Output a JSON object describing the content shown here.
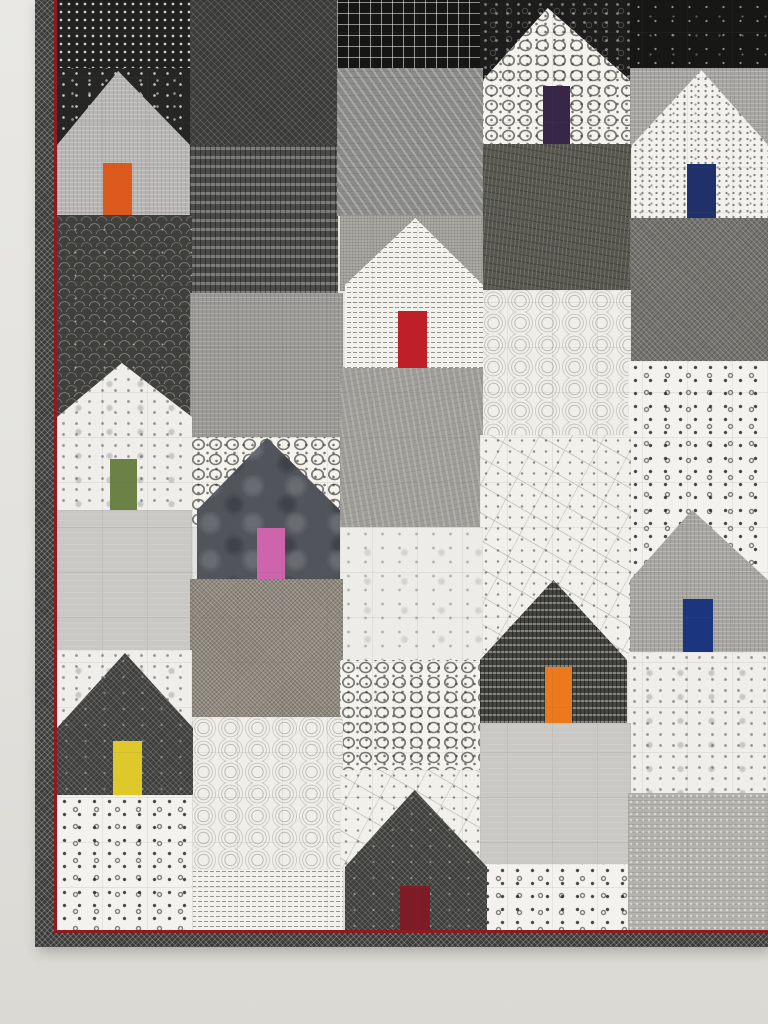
{
  "scene": {
    "alt_text": "Modern patchwork wall quilt of pieced house blocks in black, white and gray printed fabrics, each house with a single bright colored door, bound in dark fabric with a thin red flange, hanging on a pale gray wall"
  },
  "wall": {
    "color_top": "#e9e8e4",
    "color_bottom": "#dbd9d4"
  },
  "quilt": {
    "x": 35,
    "y": 0,
    "width": 733,
    "height": 947,
    "binding_color": "#3a3a38",
    "flange_color": "#8e1b22",
    "quilting_grid_spacing_px": 45,
    "binding": [
      {
        "name": "binding-left",
        "kind": "binding",
        "x": 35,
        "y": 0,
        "w": 19,
        "h": 947
      },
      {
        "name": "binding-bottom",
        "kind": "binding",
        "x": 35,
        "y": 933,
        "w": 733,
        "h": 14
      },
      {
        "name": "flange-left",
        "kind": "flange",
        "x": 54,
        "y": 0,
        "w": 3,
        "h": 933
      },
      {
        "name": "flange-bottom",
        "kind": "flange",
        "x": 54,
        "y": 930,
        "w": 714,
        "h": 3
      }
    ],
    "patches": [
      {
        "name": "black-dot-rows-fabric",
        "fabric": "dot-rows-black",
        "x": 57,
        "y": 0,
        "w": 135,
        "h": 70
      },
      {
        "name": "black-scatter-dots-fabric",
        "fabric": "scatter-dots-black",
        "x": 57,
        "y": 68,
        "w": 135,
        "h": 80
      },
      {
        "name": "dark-crosshatch-fabric",
        "fabric": "crosshatch-dark",
        "x": 190,
        "y": 0,
        "w": 148,
        "h": 146
      },
      {
        "name": "black-grid-fabric",
        "fabric": "grid-black",
        "x": 337,
        "y": 0,
        "w": 146,
        "h": 69
      },
      {
        "name": "black-pebble-fabric",
        "fabric": "pebble-black",
        "x": 480,
        "y": 0,
        "w": 152,
        "h": 86
      },
      {
        "name": "black-flecked-fabric",
        "fabric": "flecked-black",
        "x": 630,
        "y": 0,
        "w": 138,
        "h": 70
      },
      {
        "name": "gray-linen-strip",
        "fabric": "linen-mid",
        "x": 630,
        "y": 68,
        "w": 138,
        "h": 80
      },
      {
        "name": "dark-dash-fabric",
        "fabric": "bamboo-dash",
        "x": 190,
        "y": 145,
        "w": 148,
        "h": 149
      },
      {
        "name": "gray-diagonal-fabric",
        "fabric": "diag-fleck-gray",
        "x": 337,
        "y": 68,
        "w": 146,
        "h": 148
      },
      {
        "name": "dark-wavy-fabric",
        "fabric": "wavy-dark",
        "x": 483,
        "y": 144,
        "w": 148,
        "h": 147
      },
      {
        "name": "gray-weave-fabric",
        "fabric": "weave-gray",
        "x": 630,
        "y": 218,
        "w": 138,
        "h": 144
      },
      {
        "name": "clamshell-fabric",
        "fabric": "clamshell",
        "x": 57,
        "y": 215,
        "w": 135,
        "h": 203
      },
      {
        "name": "gray-linen-fabric",
        "fabric": "linen-gray",
        "x": 190,
        "y": 293,
        "w": 153,
        "h": 145
      },
      {
        "name": "burlap-fabric",
        "fabric": "burlap",
        "x": 340,
        "y": 215,
        "w": 143,
        "h": 76
      },
      {
        "name": "swirl-rings-fabric",
        "fabric": "swirl-rings",
        "x": 480,
        "y": 290,
        "w": 151,
        "h": 146
      },
      {
        "name": "white-square-dots-fabric",
        "fabric": "dots-square-white",
        "x": 628,
        "y": 361,
        "w": 140,
        "h": 220
      },
      {
        "name": "white-squares-print-fabric",
        "fabric": "squares-print-white",
        "x": 190,
        "y": 437,
        "w": 153,
        "h": 90
      },
      {
        "name": "gray-grunge-fabric",
        "fabric": "gray-grunge",
        "x": 340,
        "y": 367,
        "w": 143,
        "h": 161
      },
      {
        "name": "constellation-fabric",
        "fabric": "constellation",
        "x": 480,
        "y": 435,
        "w": 151,
        "h": 228
      },
      {
        "name": "white-grunge-fabric",
        "fabric": "white-grunge",
        "x": 340,
        "y": 527,
        "w": 143,
        "h": 151
      },
      {
        "name": "light-gray-fabric",
        "fabric": "light-gray-solid",
        "x": 57,
        "y": 510,
        "w": 135,
        "h": 143
      },
      {
        "name": "tweed-fabric",
        "fabric": "tweed",
        "x": 190,
        "y": 579,
        "w": 153,
        "h": 140
      },
      {
        "name": "white-speckle-fabric",
        "fabric": "speckle-white",
        "x": 57,
        "y": 650,
        "w": 135,
        "h": 82
      },
      {
        "name": "white-speckle-fabric",
        "fabric": "speckle-white",
        "x": 628,
        "y": 652,
        "w": 140,
        "h": 143
      },
      {
        "name": "white-squares-print-fabric",
        "fabric": "squares-print-white",
        "x": 340,
        "y": 660,
        "w": 148,
        "h": 135
      },
      {
        "name": "swirl-rings-fabric",
        "fabric": "swirl-rings",
        "x": 190,
        "y": 717,
        "w": 153,
        "h": 153
      },
      {
        "name": "constellation-fabric",
        "fabric": "constellation",
        "x": 340,
        "y": 770,
        "w": 148,
        "h": 100
      },
      {
        "name": "light-gray-fabric",
        "fabric": "light-gray-solid",
        "x": 480,
        "y": 723,
        "w": 151,
        "h": 142
      },
      {
        "name": "text-print-fabric",
        "fabric": "text-print",
        "x": 190,
        "y": 869,
        "w": 153,
        "h": 63
      },
      {
        "name": "white-square-dots-fabric",
        "fabric": "dots-square-white",
        "x": 57,
        "y": 795,
        "w": 136,
        "h": 137
      },
      {
        "name": "white-square-dots-fabric",
        "fabric": "dots-square-white",
        "x": 480,
        "y": 864,
        "w": 151,
        "h": 68
      },
      {
        "name": "gray-lace-fabric",
        "fabric": "lace-gray",
        "x": 628,
        "y": 793,
        "w": 140,
        "h": 140
      }
    ],
    "houses": [
      {
        "name": "house-gray-orange-door",
        "fabric": "linen-light",
        "x": 57,
        "y": 71,
        "w": 133,
        "h": 144,
        "roof_h": 74,
        "apex": 0.46,
        "door": {
          "dx": 46,
          "w": 29,
          "h": 52,
          "color": "#dd5a1e"
        }
      },
      {
        "name": "house-white-green-door",
        "fabric": "speckle-white",
        "x": 57,
        "y": 363,
        "w": 135,
        "h": 147,
        "roof_h": 54,
        "apex": 0.48,
        "door": {
          "dx": 53,
          "w": 27,
          "h": 51,
          "color": "#6b8146"
        }
      },
      {
        "name": "house-dark-yellow-door",
        "fabric": "diamond-dark",
        "x": 57,
        "y": 653,
        "w": 136,
        "h": 142,
        "roof_h": 75,
        "apex": 0.5,
        "door": {
          "dx": 56,
          "w": 29,
          "h": 54,
          "color": "#ddca2a"
        }
      },
      {
        "name": "house-slate-pink-door",
        "fabric": "batik-slate",
        "x": 197,
        "y": 438,
        "w": 143,
        "h": 141,
        "roof_h": 72,
        "apex": 0.49,
        "door": {
          "dx": 60,
          "w": 28,
          "h": 51,
          "color": "#ce64ac"
        }
      },
      {
        "name": "house-text-red-door",
        "fabric": "text-print",
        "x": 345,
        "y": 218,
        "w": 138,
        "h": 150,
        "roof_h": 67,
        "apex": 0.51,
        "door": {
          "dx": 53,
          "w": 29,
          "h": 57,
          "color": "#bf1f27"
        }
      },
      {
        "name": "house-white-purple-door",
        "fabric": "squares-print-white",
        "x": 483,
        "y": 8,
        "w": 147,
        "h": 136,
        "roof_h": 72,
        "apex": 0.44,
        "door": {
          "dx": 60,
          "w": 27,
          "h": 58,
          "color": "#372647"
        }
      },
      {
        "name": "house-dark-orange-door",
        "fabric": "dash-dark",
        "x": 480,
        "y": 580,
        "w": 147,
        "h": 143,
        "roof_h": 80,
        "apex": 0.5,
        "door": {
          "dx": 65,
          "w": 27,
          "h": 56,
          "color": "#ec7a1c"
        }
      },
      {
        "name": "house-white-navy-door",
        "fabric": "pin-dots-white",
        "x": 632,
        "y": 70,
        "w": 136,
        "h": 148,
        "roof_h": 75,
        "apex": 0.51,
        "door": {
          "dx": 55,
          "w": 29,
          "h": 54,
          "color": "#20306b"
        }
      },
      {
        "name": "house-linen-blue-door",
        "fabric": "linen-mid",
        "x": 630,
        "y": 510,
        "w": 138,
        "h": 142,
        "roof_h": 70,
        "apex": 0.45,
        "door": {
          "dx": 53,
          "w": 30,
          "h": 53,
          "color": "#1c357f"
        }
      },
      {
        "name": "house-dark-maroon-door",
        "fabric": "diamond-dark",
        "x": 345,
        "y": 790,
        "w": 142,
        "h": 143,
        "roof_h": 77,
        "apex": 0.49,
        "door": {
          "dx": 55,
          "w": 30,
          "h": 47,
          "color": "#7d1c25"
        }
      }
    ]
  }
}
